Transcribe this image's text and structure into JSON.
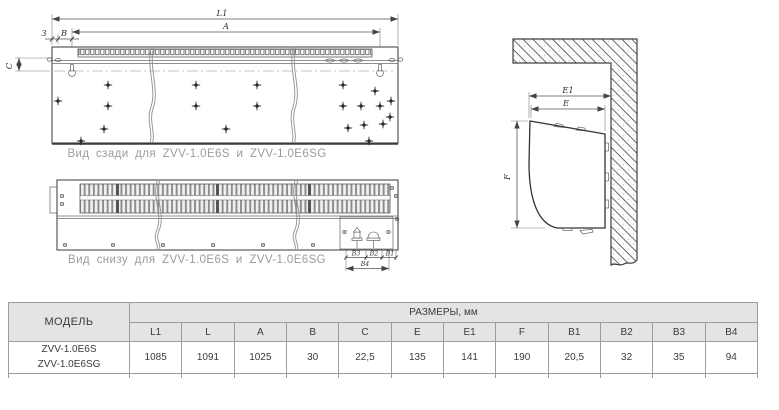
{
  "colors": {
    "line": "#4a4a4a",
    "caption_text": "#9b9b9b",
    "table_border": "#9c9c9c",
    "table_header_bg": "#e4e4e4",
    "text": "#3b3b3b"
  },
  "drawings": {
    "rear_view": {
      "caption": "Вид сзади для ZVV-1.0E6S и ZVV-1.0E6SG",
      "dim_l1": "L1",
      "dim_a": "A",
      "dim_3": "3",
      "dim_b": "B",
      "dim_c": "C"
    },
    "bottom_view": {
      "caption": "Вид снизу для ZVV-1.0E6S и ZVV-1.0E6SG",
      "dim_b3": "B3",
      "dim_b2": "B2",
      "dim_b1": "B1",
      "dim_b4": "B4"
    },
    "side_view": {
      "dim_e1": "E1",
      "dim_e": "E",
      "dim_f": "F"
    }
  },
  "table": {
    "model_header": "МОДЕЛЬ",
    "sizes_header": "РАЗМЕРЫ, мм",
    "columns": [
      "L1",
      "L",
      "A",
      "B",
      "C",
      "E",
      "E1",
      "F",
      "B1",
      "B2",
      "B3",
      "B4"
    ],
    "rows": [
      {
        "model_line1": "ZVV-1.0E6S",
        "model_line2": "ZVV-1.0E6SG",
        "values": [
          "1085",
          "1091",
          "1025",
          "30",
          "22,5",
          "135",
          "141",
          "190",
          "20,5",
          "32",
          "35",
          "94"
        ]
      }
    ]
  }
}
